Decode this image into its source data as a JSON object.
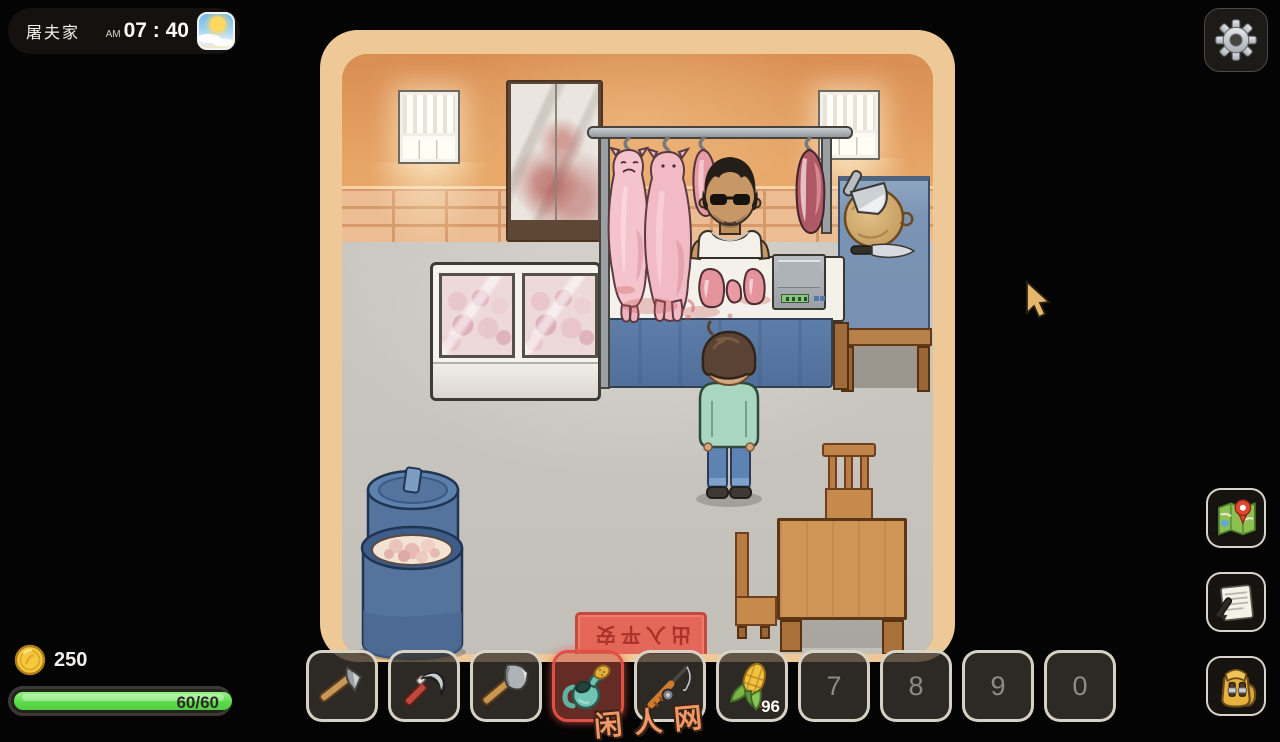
{
  "hud": {
    "location": "屠夫家",
    "time_meridiem": "AM",
    "time_value": "07 : 40",
    "coins": "250",
    "stamina_display": "60/60",
    "stamina_current": 60,
    "stamina_max": 60
  },
  "icons": {
    "weather": "sunny-weather-icon",
    "settings": "gear-icon",
    "map": "map-icon",
    "journal": "notebook-icon",
    "inventory": "backpack-icon",
    "currency": "gold-coin-icon"
  },
  "colors": {
    "selected_slot_accent": "#e14f44",
    "stamina_fill": "#5edb4c",
    "coin_gold": "#f6c93c",
    "doormat_red": "#e4675a",
    "room_frame_tan": "#eec997"
  },
  "hotbar": {
    "selected_index": 3,
    "slots": [
      {
        "item": "hoe",
        "count": "",
        "number": ""
      },
      {
        "item": "sickle",
        "count": "",
        "number": ""
      },
      {
        "item": "axe",
        "count": "",
        "number": ""
      },
      {
        "item": "watering-can",
        "count": "",
        "number": ""
      },
      {
        "item": "fishing-rod",
        "count": "",
        "number": ""
      },
      {
        "item": "corn",
        "count": "96",
        "number": ""
      },
      {
        "item": "",
        "count": "",
        "number": "7"
      },
      {
        "item": "",
        "count": "",
        "number": "8"
      },
      {
        "item": "",
        "count": "",
        "number": "9"
      },
      {
        "item": "",
        "count": "",
        "number": "0"
      }
    ]
  },
  "scene": {
    "doormat_text": "出入平安",
    "watermark": "闲人网"
  }
}
